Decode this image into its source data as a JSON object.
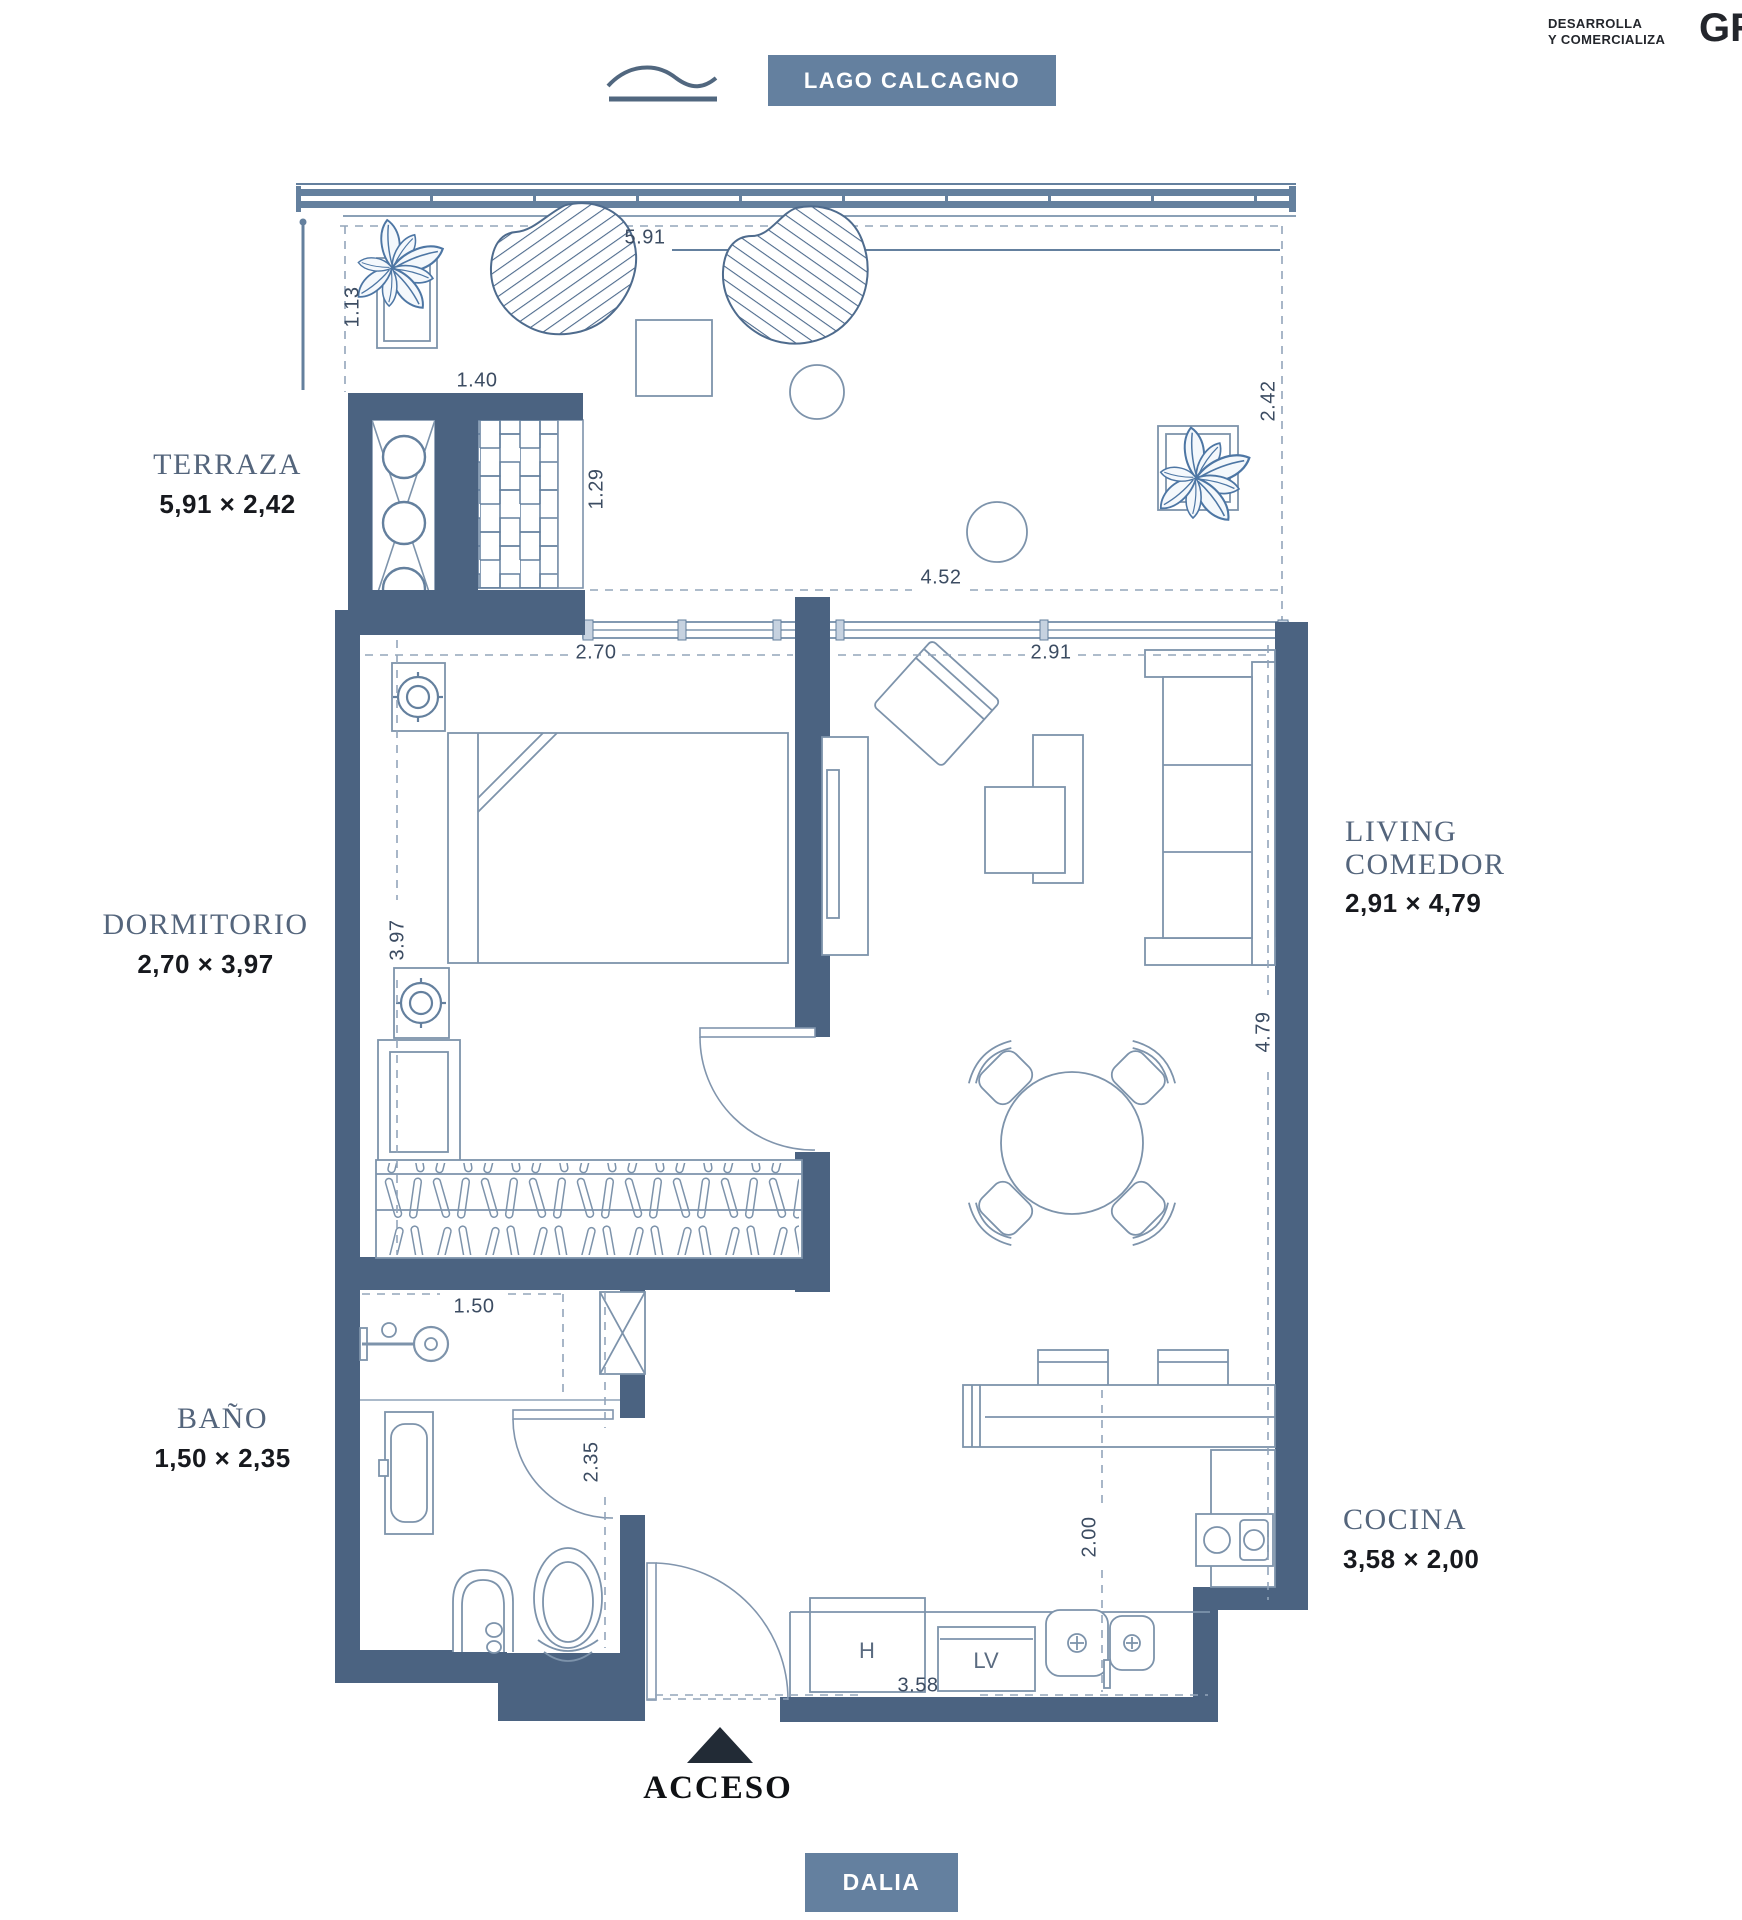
{
  "header": {
    "badge": "LAGO CALCAGNO",
    "developer_line1": "DESARROLLA",
    "developer_line2": "Y COMERCIALIZA",
    "logo": "GR"
  },
  "rooms": {
    "terraza": {
      "name": "TERRAZA",
      "size": "5,91 × 2,42"
    },
    "dormitorio": {
      "name": "DORMITORIO",
      "size": "2,70 × 3,97"
    },
    "bano": {
      "name": "BAÑO",
      "size": "1,50 × 2,35"
    },
    "living": {
      "name_line1": "LIVING",
      "name_line2": "COMEDOR",
      "size": "2,91 × 4,79"
    },
    "cocina": {
      "name": "COCINA",
      "size": "3,58 × 2,00"
    }
  },
  "dimensions": {
    "terrace_width": "5.91",
    "terrace_side": "1.13",
    "grill_width": "1.40",
    "grill_depth": "1.29",
    "terrace_depth": "2.42",
    "slider_width": "4.52",
    "bedroom_width": "2.70",
    "bedroom_depth": "3.97",
    "living_width": "2.91",
    "living_depth": "4.79",
    "bath_width": "1.50",
    "bath_depth": "2.35",
    "kitchen_width": "3.58",
    "kitchen_depth": "2.00"
  },
  "labels": {
    "access": "ACCESO",
    "street_badge": "DALIA",
    "oven": "H",
    "dishwasher": "LV"
  },
  "colors": {
    "wall": "#4b6381",
    "badge_bg": "#64809f",
    "line": "#7d93ab",
    "line_strong": "#64809e",
    "access_arrow": "#222b36",
    "room_label": "#54657c",
    "dim_text": "#3c4c62"
  }
}
